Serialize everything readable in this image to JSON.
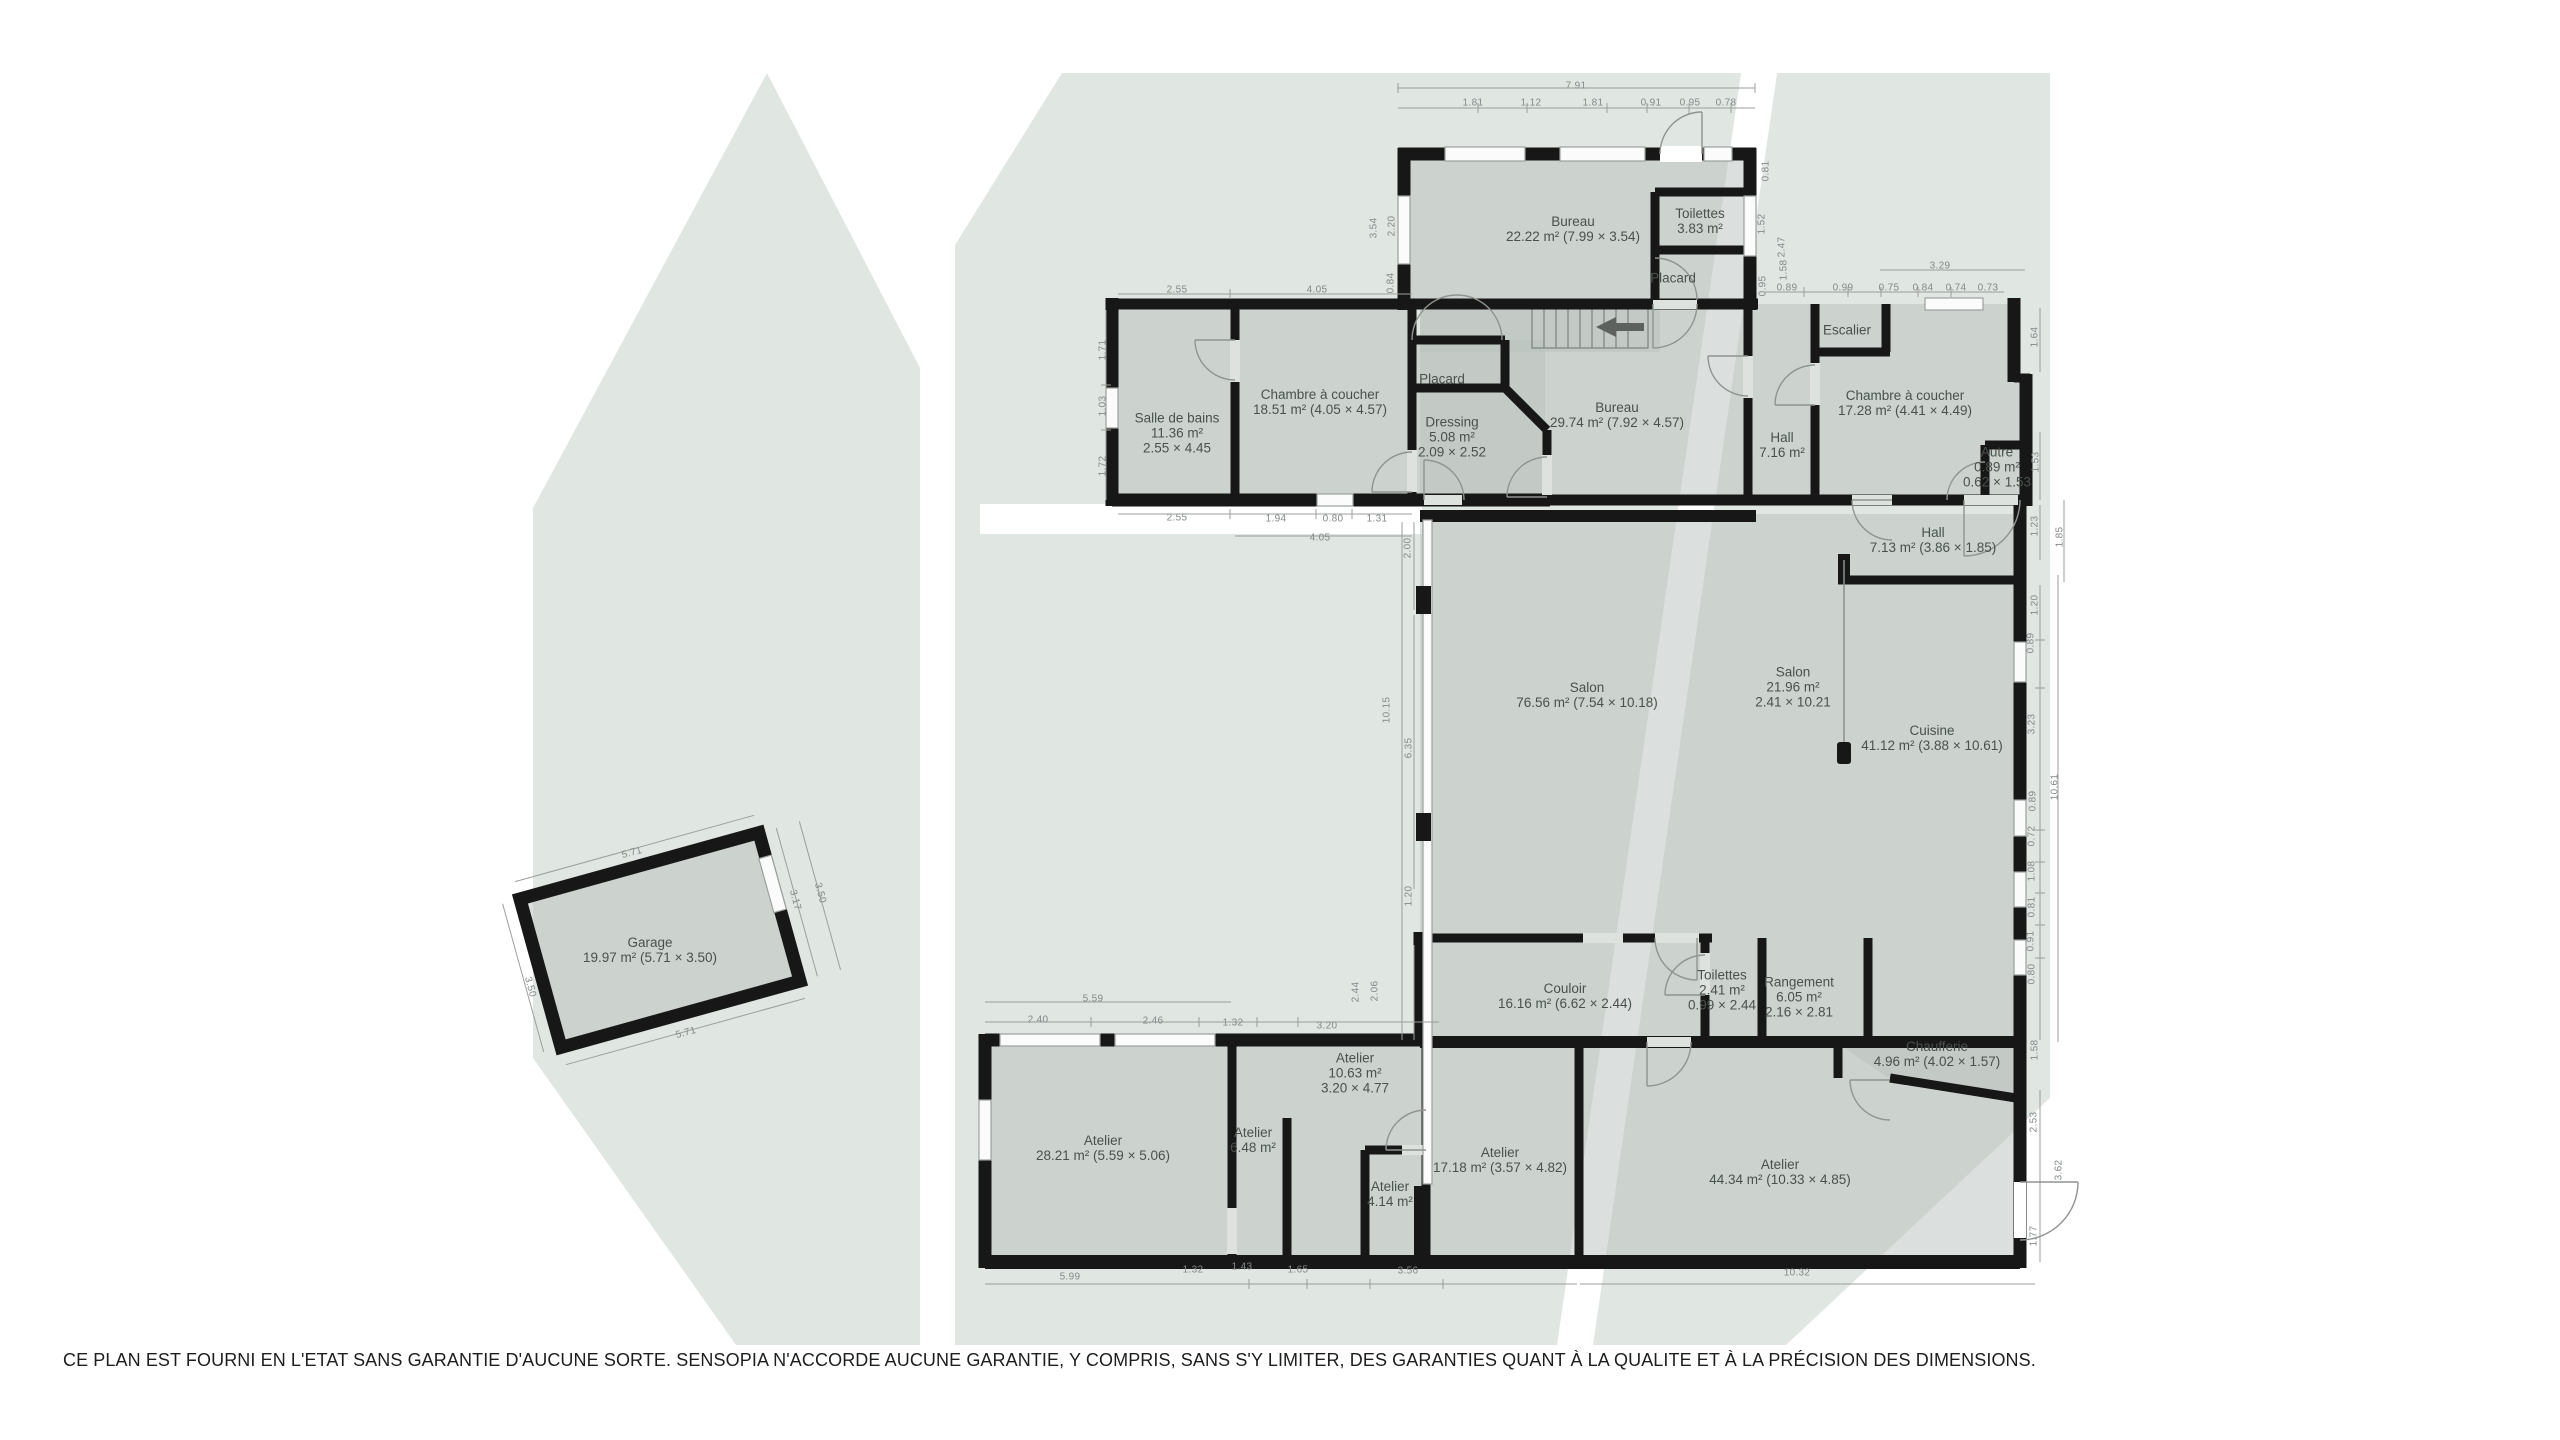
{
  "palette": {
    "background": "#ffffff",
    "watermark": "#e0e6e2",
    "room_fill": "#ccd4cf",
    "wall": "#171717",
    "dimension_text": "#84898a",
    "label_text": "#49514c"
  },
  "footer": {
    "disclaimer": "CE PLAN EST FOURNI EN L'ETAT SANS GARANTIE D'AUCUNE SORTE. SENSOPIA N'ACCORDE AUCUNE GARANTIE, Y COMPRIS, SANS S'Y LIMITER, DES GARANTIES QUANT À LA QUALITE ET À LA PRÉCISION DES DIMENSIONS."
  },
  "floor_plan": {
    "rooms": [
      {
        "id": "bureau-haut",
        "lines": [
          "Bureau",
          "22.22 m² (7.99 × 3.54)"
        ],
        "x": 1573,
        "y": 229
      },
      {
        "id": "toilettes-haut",
        "lines": [
          "Toilettes",
          "3.83 m²"
        ],
        "x": 1700,
        "y": 221
      },
      {
        "id": "placard-haut",
        "lines": [
          "Placard"
        ],
        "x": 1673,
        "y": 278
      },
      {
        "id": "salle-de-bains",
        "lines": [
          "Salle de bains",
          "11.36 m²",
          "2.55 × 4.45"
        ],
        "x": 1177,
        "y": 433
      },
      {
        "id": "chambre-a-coucher-1",
        "lines": [
          "Chambre à coucher",
          "18.51 m² (4.05 × 4.57)"
        ],
        "x": 1320,
        "y": 402
      },
      {
        "id": "placard-2",
        "lines": [
          "Placard"
        ],
        "x": 1442,
        "y": 379
      },
      {
        "id": "dressing",
        "lines": [
          "Dressing",
          "5.08 m²",
          "2.09 × 2.52"
        ],
        "x": 1452,
        "y": 437
      },
      {
        "id": "bureau-centre",
        "lines": [
          "Bureau",
          "29.74 m² (7.92 × 4.57)"
        ],
        "x": 1617,
        "y": 415
      },
      {
        "id": "hall-716",
        "lines": [
          "Hall",
          "7.16 m²"
        ],
        "x": 1782,
        "y": 445
      },
      {
        "id": "escalier",
        "lines": [
          "Escalier"
        ],
        "x": 1847,
        "y": 330
      },
      {
        "id": "chambre-a-coucher-2",
        "lines": [
          "Chambre à coucher",
          "17.28 m² (4.41 × 4.49)"
        ],
        "x": 1905,
        "y": 403
      },
      {
        "id": "autre",
        "lines": [
          "Autre",
          "0.89 m²",
          "0.62 × 1.53"
        ],
        "x": 1997,
        "y": 467
      },
      {
        "id": "hall-713",
        "lines": [
          "Hall",
          "7.13 m² (3.86 × 1.85)"
        ],
        "x": 1933,
        "y": 540
      },
      {
        "id": "salon-grand",
        "lines": [
          "Salon",
          "76.56 m² (7.54 × 10.18)"
        ],
        "x": 1587,
        "y": 695
      },
      {
        "id": "salon-petit",
        "lines": [
          "Salon",
          "21.96 m²",
          "2.41 × 10.21"
        ],
        "x": 1793,
        "y": 687
      },
      {
        "id": "cuisine",
        "lines": [
          "Cuisine",
          "41.12 m² (3.88 × 10.61)"
        ],
        "x": 1932,
        "y": 738
      },
      {
        "id": "garage",
        "lines": [
          "Garage",
          "19.97 m² (5.71 × 3.50)"
        ],
        "x": 650,
        "y": 950
      },
      {
        "id": "couloir",
        "lines": [
          "Couloir",
          "16.16 m² (6.62 × 2.44)"
        ],
        "x": 1565,
        "y": 996
      },
      {
        "id": "toilettes-bas",
        "lines": [
          "Toilettes",
          "2.41 m²",
          "0.99 × 2.44"
        ],
        "x": 1722,
        "y": 990
      },
      {
        "id": "rangement",
        "lines": [
          "Rangement",
          "6.05 m²",
          "2.16 × 2.81"
        ],
        "x": 1799,
        "y": 997
      },
      {
        "id": "chaufferie",
        "lines": [
          "Chaufferie",
          "4.96 m² (4.02 × 1.57)"
        ],
        "x": 1937,
        "y": 1054
      },
      {
        "id": "atelier-2821",
        "lines": [
          "Atelier",
          "28.21 m² (5.59 × 5.06)"
        ],
        "x": 1103,
        "y": 1148
      },
      {
        "id": "atelier-648",
        "lines": [
          "Atelier",
          "6.48 m²"
        ],
        "x": 1253,
        "y": 1140
      },
      {
        "id": "atelier-1063",
        "lines": [
          "Atelier",
          "10.63 m²",
          "3.20 × 4.77"
        ],
        "x": 1355,
        "y": 1073
      },
      {
        "id": "atelier-414",
        "lines": [
          "Atelier",
          "4.14 m²"
        ],
        "x": 1390,
        "y": 1194
      },
      {
        "id": "atelier-1718",
        "lines": [
          "Atelier",
          "17.18 m² (3.57 × 4.82)"
        ],
        "x": 1500,
        "y": 1160
      },
      {
        "id": "atelier-4434",
        "lines": [
          "Atelier",
          "44.34 m² (10.33 × 4.85)"
        ],
        "x": 1780,
        "y": 1172
      }
    ],
    "dimensions": [
      {
        "v": "7.91",
        "x": 1576,
        "y": 86,
        "r": 0
      },
      {
        "v": "1.81",
        "x": 1473,
        "y": 103,
        "r": 0
      },
      {
        "v": "1.12",
        "x": 1531,
        "y": 103,
        "r": 0
      },
      {
        "v": "1.81",
        "x": 1593,
        "y": 103,
        "r": 0
      },
      {
        "v": "0.91",
        "x": 1651,
        "y": 103,
        "r": 0
      },
      {
        "v": "0.95",
        "x": 1690,
        "y": 103,
        "r": 0
      },
      {
        "v": "0.78",
        "x": 1726,
        "y": 103,
        "r": 0
      },
      {
        "v": "3.54",
        "x": 1374,
        "y": 228,
        "r": -90
      },
      {
        "v": "2.20",
        "x": 1392,
        "y": 226,
        "r": -90
      },
      {
        "v": "0.84",
        "x": 1391,
        "y": 283,
        "r": -90
      },
      {
        "v": "0.81",
        "x": 1766,
        "y": 171,
        "r": -90
      },
      {
        "v": "1.52",
        "x": 1762,
        "y": 224,
        "r": -90
      },
      {
        "v": "2.47",
        "x": 1782,
        "y": 247,
        "r": -90
      },
      {
        "v": "1.58",
        "x": 1784,
        "y": 270,
        "r": -90
      },
      {
        "v": "0.95",
        "x": 1763,
        "y": 286,
        "r": -90
      },
      {
        "v": "0.89",
        "x": 1787,
        "y": 288,
        "r": 0
      },
      {
        "v": "0.99",
        "x": 1843,
        "y": 288,
        "r": 0
      },
      {
        "v": "0.75",
        "x": 1889,
        "y": 288,
        "r": 0
      },
      {
        "v": "0.84",
        "x": 1923,
        "y": 288,
        "r": 0
      },
      {
        "v": "0.74",
        "x": 1956,
        "y": 288,
        "r": 0
      },
      {
        "v": "0.73",
        "x": 1988,
        "y": 288,
        "r": 0
      },
      {
        "v": "3.29",
        "x": 1940,
        "y": 266,
        "r": 0
      },
      {
        "v": "1.64",
        "x": 2035,
        "y": 337,
        "r": -90
      },
      {
        "v": "1.53",
        "x": 2036,
        "y": 462,
        "r": -90
      },
      {
        "v": "1.23",
        "x": 2035,
        "y": 526,
        "r": -90
      },
      {
        "v": "1.85",
        "x": 2060,
        "y": 537,
        "r": -90
      },
      {
        "v": "1.20",
        "x": 2035,
        "y": 605,
        "r": -90
      },
      {
        "v": "2.55",
        "x": 1177,
        "y": 290,
        "r": 0
      },
      {
        "v": "4.05",
        "x": 1317,
        "y": 290,
        "r": 0
      },
      {
        "v": "1.71",
        "x": 1103,
        "y": 350,
        "r": -90
      },
      {
        "v": "1.03",
        "x": 1103,
        "y": 406,
        "r": -90
      },
      {
        "v": "1.72",
        "x": 1103,
        "y": 466,
        "r": -90
      },
      {
        "v": "2.55",
        "x": 1177,
        "y": 518,
        "r": 0
      },
      {
        "v": "1.94",
        "x": 1276,
        "y": 519,
        "r": 0
      },
      {
        "v": "0.80",
        "x": 1333,
        "y": 519,
        "r": 0
      },
      {
        "v": "1.31",
        "x": 1377,
        "y": 519,
        "r": 0
      },
      {
        "v": "4.05",
        "x": 1320,
        "y": 538,
        "r": 0
      },
      {
        "v": "2.00",
        "x": 1408,
        "y": 548,
        "r": -90
      },
      {
        "v": "10.15",
        "x": 1387,
        "y": 710,
        "r": -90
      },
      {
        "v": "6.35",
        "x": 1409,
        "y": 748,
        "r": -90
      },
      {
        "v": "1.20",
        "x": 1409,
        "y": 896,
        "r": -90
      },
      {
        "v": "0.89",
        "x": 2031,
        "y": 643,
        "r": -90
      },
      {
        "v": "3.23",
        "x": 2032,
        "y": 724,
        "r": -90
      },
      {
        "v": "10.61",
        "x": 2055,
        "y": 787,
        "r": -90
      },
      {
        "v": "0.89",
        "x": 2033,
        "y": 801,
        "r": -90
      },
      {
        "v": "0.72",
        "x": 2032,
        "y": 836,
        "r": -90
      },
      {
        "v": "1.08",
        "x": 2032,
        "y": 871,
        "r": -90
      },
      {
        "v": "0.81",
        "x": 2032,
        "y": 907,
        "r": -90
      },
      {
        "v": "0.91",
        "x": 2031,
        "y": 941,
        "r": -90
      },
      {
        "v": "0.80",
        "x": 2032,
        "y": 974,
        "r": -90
      },
      {
        "v": "1.58",
        "x": 2035,
        "y": 1050,
        "r": -90
      },
      {
        "v": "2.53",
        "x": 2034,
        "y": 1122,
        "r": -90
      },
      {
        "v": "3.62",
        "x": 2059,
        "y": 1170,
        "r": -90
      },
      {
        "v": "1.77",
        "x": 2034,
        "y": 1236,
        "r": -90
      },
      {
        "v": "5.99",
        "x": 1070,
        "y": 1277,
        "r": 0
      },
      {
        "v": "1.32",
        "x": 1193,
        "y": 1270,
        "r": 0
      },
      {
        "v": "1.43",
        "x": 1242,
        "y": 1267,
        "r": 0
      },
      {
        "v": "1.65",
        "x": 1298,
        "y": 1270,
        "r": 0
      },
      {
        "v": "3.56",
        "x": 1408,
        "y": 1271,
        "r": 0
      },
      {
        "v": "10.32",
        "x": 1797,
        "y": 1273,
        "r": 0
      },
      {
        "v": "5.59",
        "x": 1093,
        "y": 999,
        "r": 0
      },
      {
        "v": "2.40",
        "x": 1038,
        "y": 1020,
        "r": 0
      },
      {
        "v": "2.46",
        "x": 1153,
        "y": 1021,
        "r": 0
      },
      {
        "v": "1.32",
        "x": 1233,
        "y": 1023,
        "r": 0
      },
      {
        "v": "3.20",
        "x": 1327,
        "y": 1026,
        "r": 0
      },
      {
        "v": "2.44",
        "x": 1356,
        "y": 992,
        "r": -90
      },
      {
        "v": "2.06",
        "x": 1375,
        "y": 991,
        "r": -90
      },
      {
        "v": "5.71",
        "x": 632,
        "y": 853,
        "r": -15
      },
      {
        "v": "3.17",
        "x": 795,
        "y": 900,
        "r": 75
      },
      {
        "v": "3.50",
        "x": 820,
        "y": 893,
        "r": 75
      },
      {
        "v": "5.71",
        "x": 686,
        "y": 1033,
        "r": -15
      },
      {
        "v": "3.50",
        "x": 530,
        "y": 987,
        "r": 75
      }
    ]
  }
}
